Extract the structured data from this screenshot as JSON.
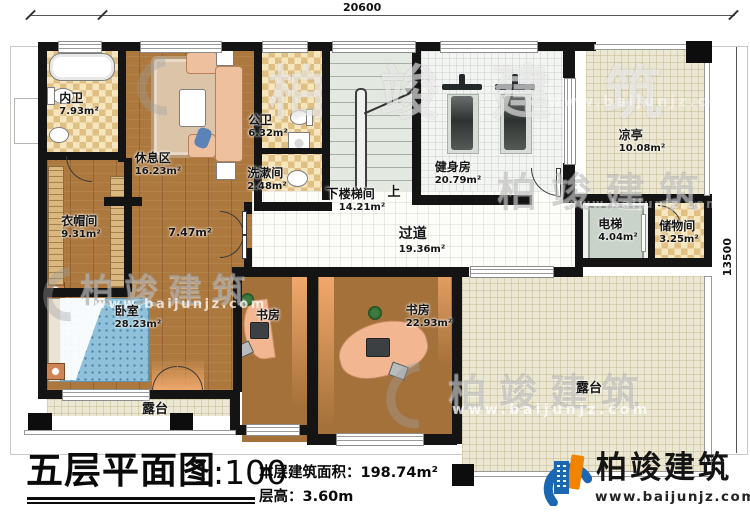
{
  "dimensions": {
    "top": "20600",
    "right": "13500"
  },
  "rooms": {
    "neiwei": {
      "name": "内卫",
      "area": "7.93m²"
    },
    "xiuxiqu": {
      "name": "休息区",
      "area": "16.23m²"
    },
    "gongwei": {
      "name": "公卫",
      "area": "6.32m²"
    },
    "xishujian": {
      "name": "洗漱间",
      "area": "2.48m²"
    },
    "loutijian": {
      "name": "楼梯间",
      "area": "14.21m²",
      "down": "下",
      "up": "上"
    },
    "jianshenfang": {
      "name": "健身房",
      "area": "20.79m²"
    },
    "liangting": {
      "name": "凉亭",
      "area": "10.08m²"
    },
    "dianti": {
      "name": "电梯",
      "area": "4.04m²"
    },
    "chuwujian": {
      "name": "储物间",
      "area": "3.25m²"
    },
    "yimaojian": {
      "name": "衣帽间",
      "area": "9.31m²"
    },
    "guodao": {
      "name": "过道",
      "area": "19.36m²"
    },
    "hall": {
      "area": "7.47m²"
    },
    "woshi": {
      "name": "卧室",
      "area": "28.23m²"
    },
    "shufang_left": {
      "name": "书房"
    },
    "shufang_right": {
      "name": "书房",
      "area": "22.93m²"
    },
    "lutai_left": {
      "name": "露台"
    },
    "lutai_right": {
      "name": "露台"
    }
  },
  "titleblock": {
    "title": "五层平面图",
    "scale": "1:100",
    "area_label": "本层建筑面积：",
    "area_value": "198.74m²",
    "height_label": "层高：",
    "height_value": "3.60m"
  },
  "brand": {
    "name": "柏竣建筑",
    "url": "www.baijunjz.com"
  },
  "watermark": {
    "text": "柏竣建筑",
    "url": "www.baijunjz.com"
  },
  "colors": {
    "wall": "#141414",
    "wood": "#ac783d",
    "checker": "#e0bf83",
    "terrace": "#ece7d2",
    "stair": "#e3e8e0",
    "brand_blue": "#1b67b2",
    "brand_orange": "#f08300"
  }
}
